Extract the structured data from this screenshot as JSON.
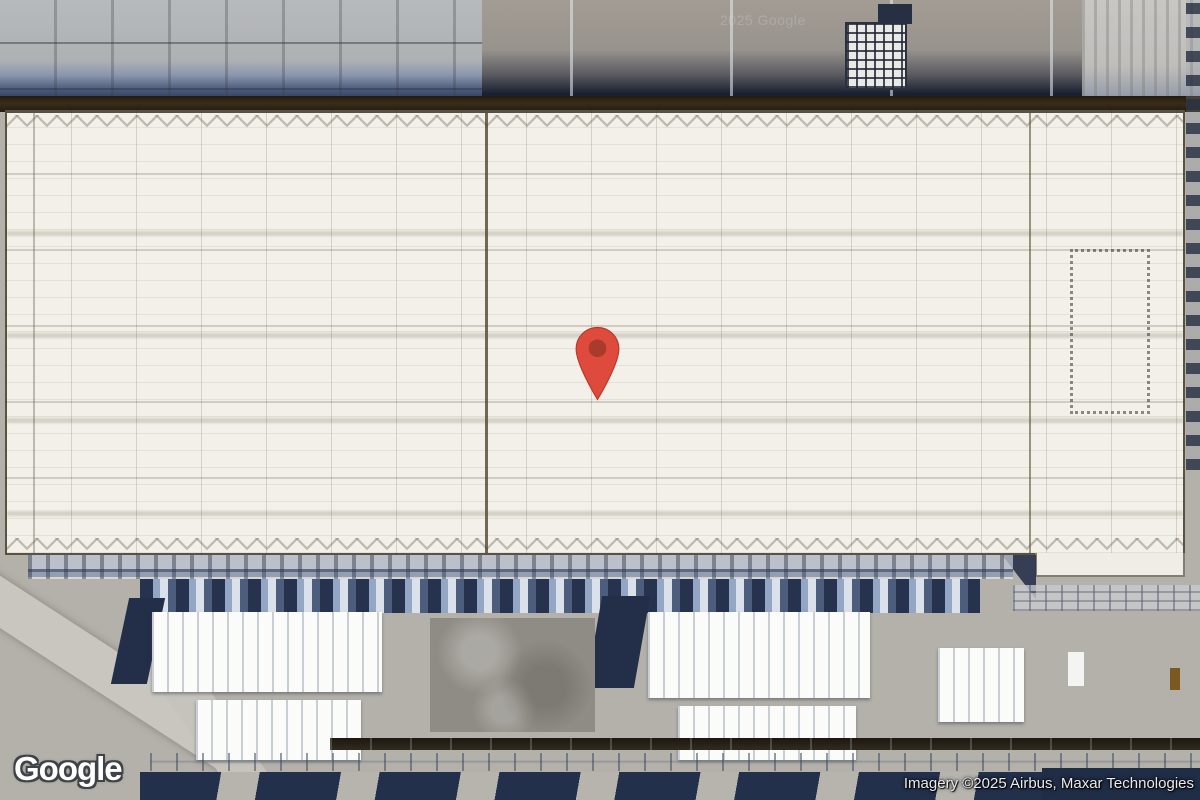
{
  "map": {
    "view_type": "satellite",
    "logo_text": "Google",
    "watermark_text": "2025 Google",
    "attribution_text": "Imagery ©2025 Airbus, Maxar Technologies",
    "marker": {
      "kind": "red-location-pin",
      "pin_color": "#DE4A3B",
      "pin_inner_color": "#A93A2C",
      "tip_x": 598,
      "tip_y": 400
    },
    "scene": {
      "description_colors": {
        "roof_white": "#f2f0e8",
        "ground_gray": "#b4b1ab",
        "shadow_navy": "#232f49",
        "pipe_blue": "#93a6c4",
        "brown_edge": "#3a2c18"
      }
    }
  }
}
